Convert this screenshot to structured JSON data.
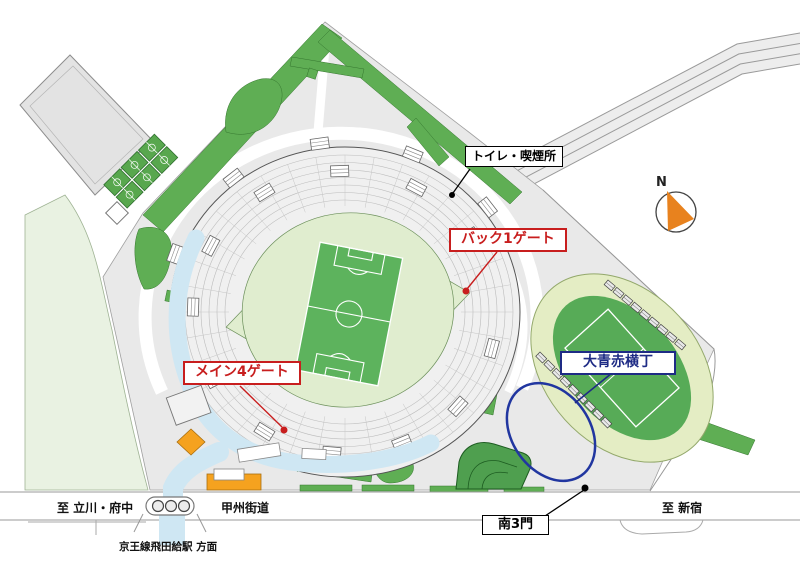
{
  "map_labels": {
    "toilet_smoking": "トイレ・喫煙所",
    "back_gate_1": "バック1ゲート",
    "main_gate_4": "メイン4ゲート",
    "yokocho": "大青赤横丁",
    "south_gate_3": "南3門",
    "to_tachikawa_fuchu": "至 立川・府中",
    "koshu_kaido": "甲州街道",
    "to_shinjuku": "至 新宿",
    "keio_line_station": "京王線飛田給駅 方面",
    "compass_north": "N"
  },
  "colors": {
    "gate_label_red": "#c81e1e",
    "yokocho_navy": "#1e2b85",
    "ellipse_blue": "#2136a0",
    "pitch_green": "#5db35d",
    "hedge_green": "#5fae54",
    "walkway_blue": "#cfe7f3",
    "building_orange": "#f5a21f",
    "compass_orange": "#e8821e"
  },
  "icons": {
    "compass": "compass-icon",
    "gate_marker": "marker-dot"
  }
}
